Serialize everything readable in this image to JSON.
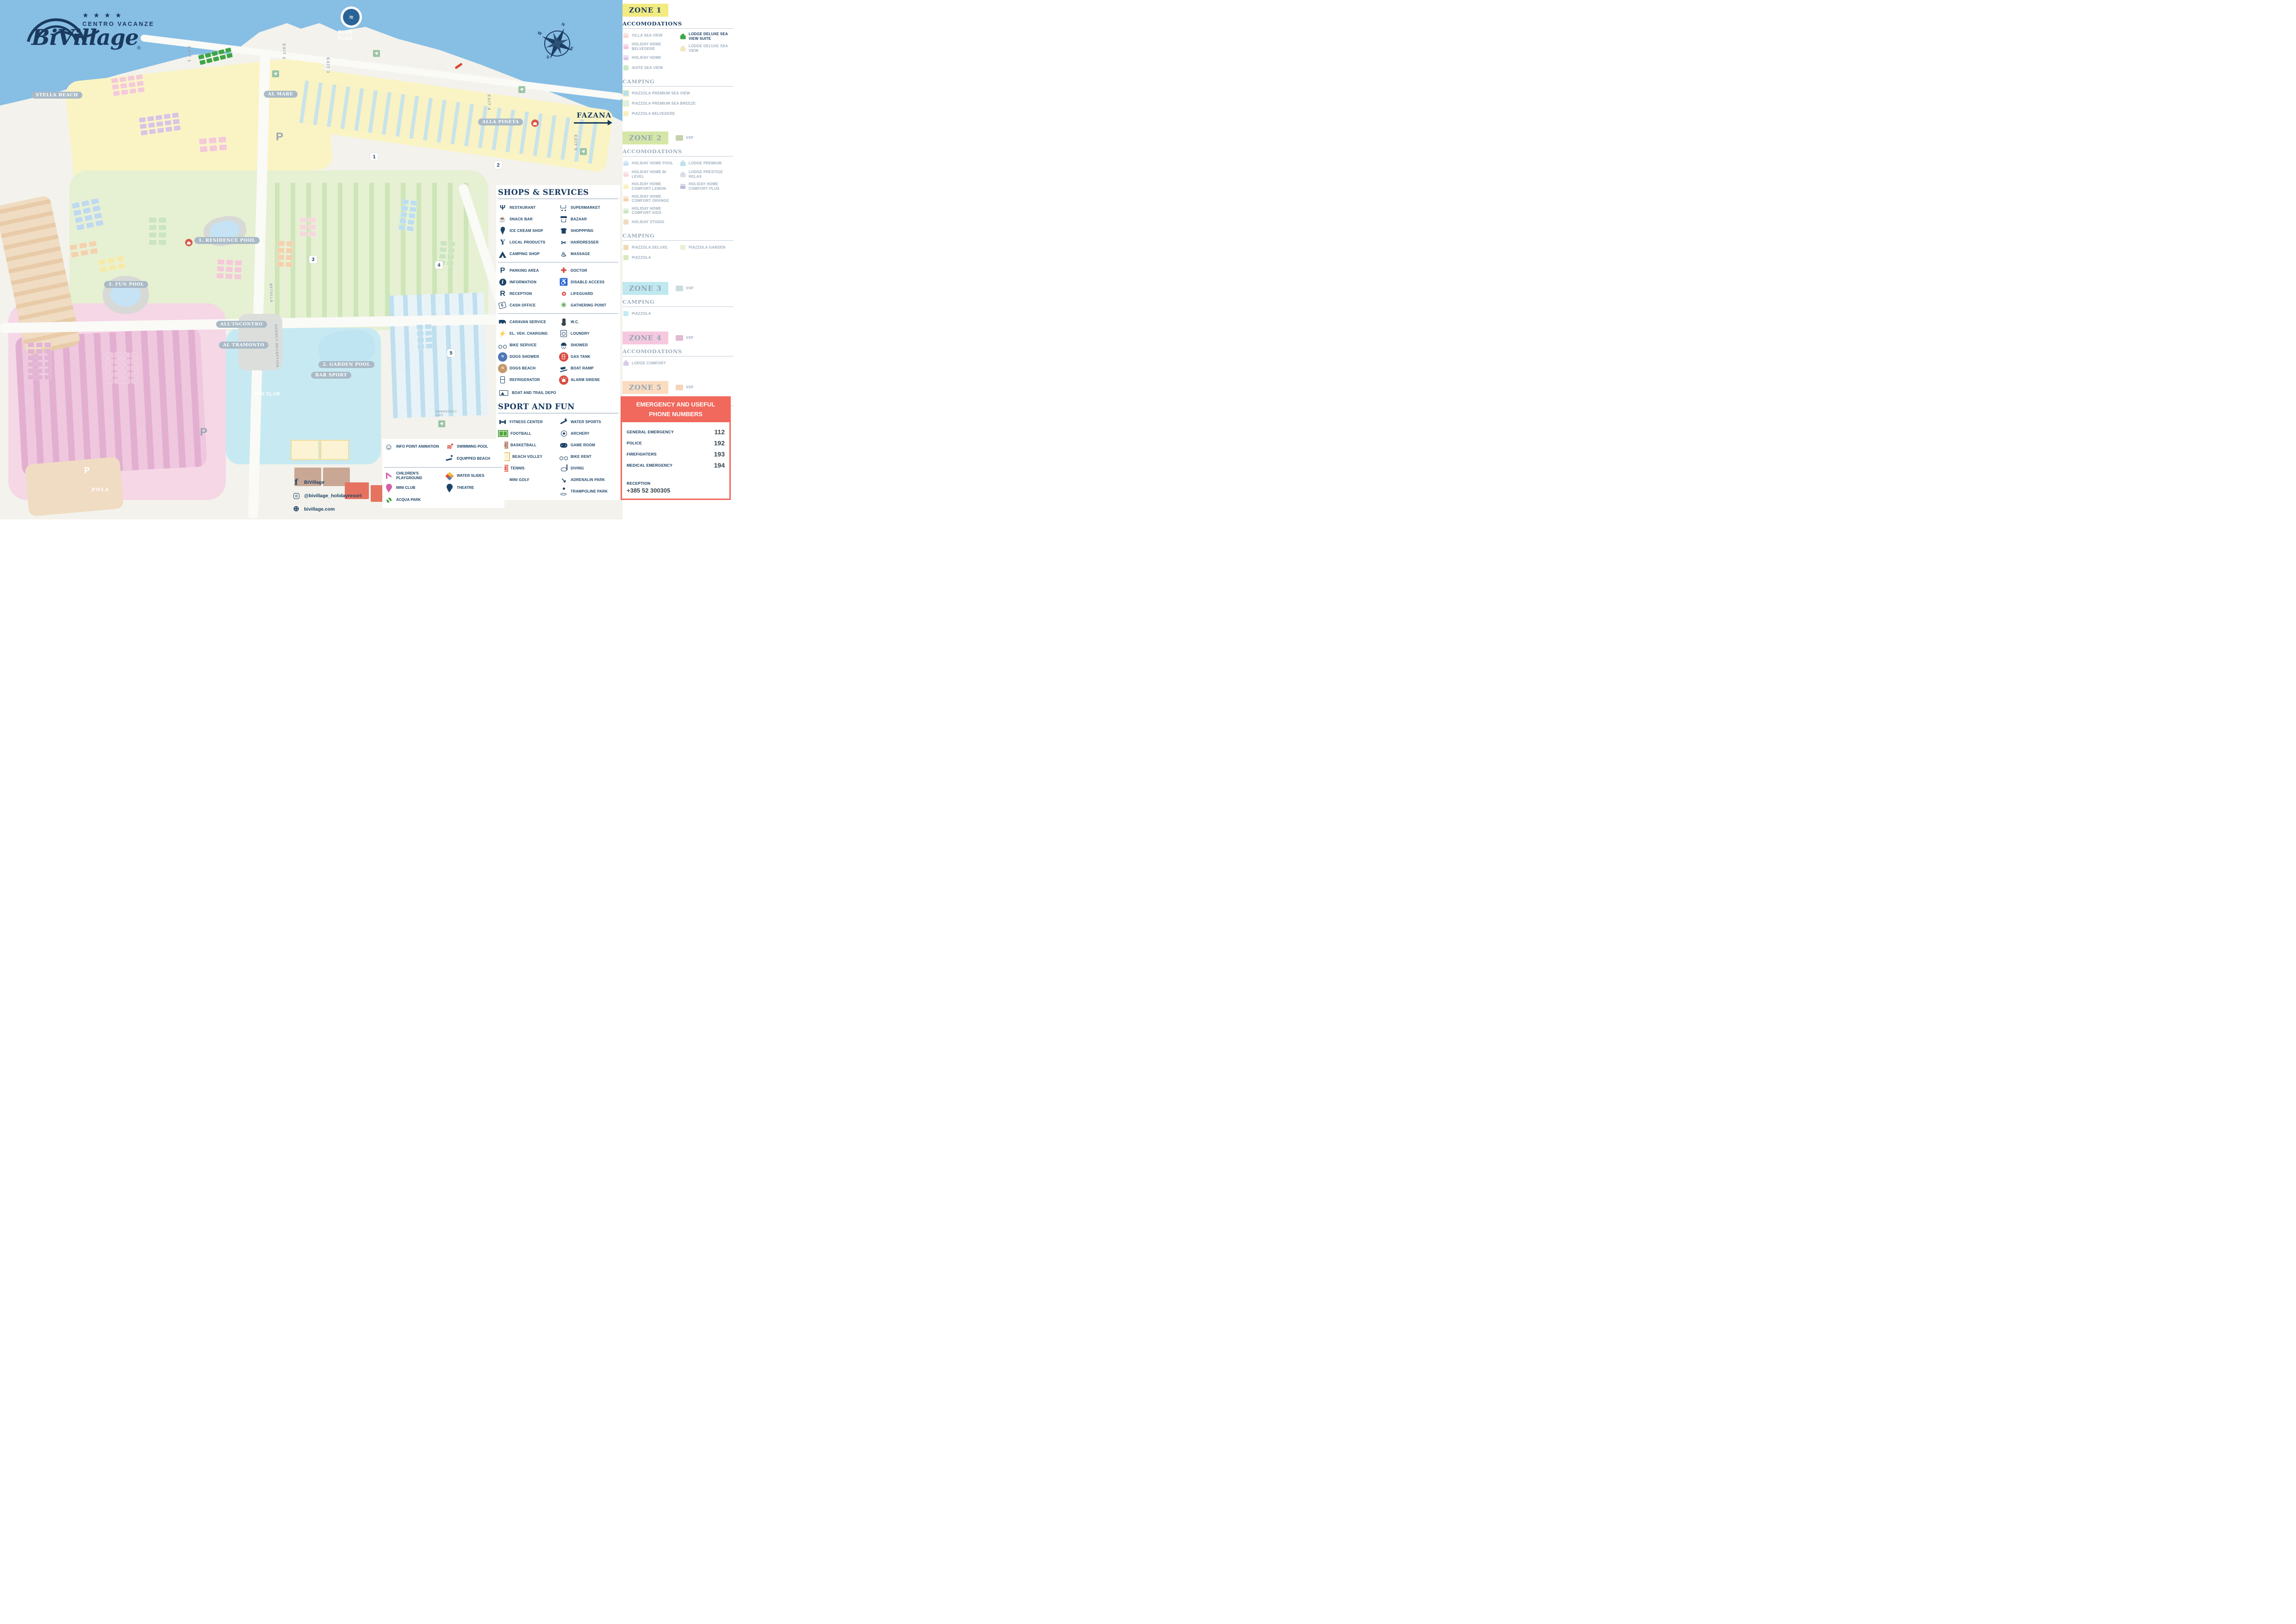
{
  "logo": {
    "stars": "★ ★ ★ ★",
    "line1": "CENTRO VACANZE",
    "name": "BiVillage",
    "reg": "®"
  },
  "vxp_label": "VXP",
  "map": {
    "sea_color": "#87BEE4",
    "labels": {
      "stella_beach": "STELLA BEACH",
      "al_mare": "AL MARE",
      "alla_pineta": "ALLA PINETA",
      "residence_pool": "1. RESIDENCE POOL",
      "fun_pool": "3. FUN POOL",
      "garden_pool": "2. GARDEN POOL",
      "bar_sport": "BAR SPORT",
      "all_incontro": "ALL'INCONTRO",
      "al_tramonto": "AL TRAMONTO",
      "mini_club": "MINI CLUB",
      "pola": "POLA",
      "fazana": "FAZANA",
      "blue_flag": "BLUE FLAG",
      "betulla": "BETULLA",
      "agency_reception": "AGENCY RECEPTION",
      "emergency_exit": "EMERGENCY EXIT"
    },
    "exits": [
      "EXIT 1",
      "EXIT 2",
      "EXIT 3",
      "EXIT 4",
      "EXIT 5"
    ],
    "zone_markers": [
      "1",
      "2",
      "3",
      "4",
      "5"
    ],
    "compass": [
      "N",
      "E",
      "S",
      "W"
    ],
    "parking_label": "P"
  },
  "zones": [
    {
      "title": "ZONE 1",
      "badge": "#F2EB82",
      "active": true,
      "sections": [
        {
          "header": "ACCOMODATIONS",
          "active": true,
          "cols": [
            [
              {
                "label": "VILLA SEA VIEW",
                "color": "#F7D9CB",
                "kind": "house"
              },
              {
                "label": "HOLIDAY HOME BELVEDERE",
                "color": "#F4C3DB",
                "kind": "house"
              },
              {
                "label": "HOLIDAY HOME",
                "color": "#DCC6E4",
                "kind": "house"
              },
              {
                "label": "SUITE SEA VIEW",
                "color": "#C9E9C4",
                "kind": "chip"
              }
            ],
            [
              {
                "label": "LODGE DELUXE SEA VIEW SUITE",
                "color": "#3FA544",
                "kind": "lodge",
                "active": true
              },
              {
                "label": "LODGE DELUXE SEA VIEW",
                "color": "#F4E3C2",
                "kind": "lodge"
              }
            ]
          ]
        },
        {
          "header": "CAMPING",
          "cols": [
            [
              {
                "label": "PIAZZOLA PREMIUM SEA VIEW",
                "color": "#BCDFF0",
                "pad": "#F7F1BF"
              },
              {
                "label": "PIAZZOLA PREMIUM SEA BREEZE",
                "color": "#DEEEE8",
                "pad": "#F7F1BF"
              },
              {
                "label": "PIAZZOLA BELVEDERE",
                "color": "#F7F1BF"
              }
            ]
          ]
        }
      ]
    },
    {
      "title": "ZONE 2",
      "badge": "#D5E6A6",
      "vxp": "#C7D1AF",
      "sections": [
        {
          "header": "ACCOMODATIONS",
          "cols": [
            [
              {
                "label": "HOLIDAY HOME POOL",
                "color": "#C6DFF2",
                "kind": "house"
              },
              {
                "label": "HOLIDAY HOME BI LEVEL",
                "color": "#F6D8DB",
                "kind": "house"
              },
              {
                "label": "HOLIDAY HOME COMFORT LEMON",
                "color": "#F6F0BC",
                "kind": "house"
              },
              {
                "label": "HOLIDAY HOME COMFORT ORANGE",
                "color": "#F3D2AF",
                "kind": "house"
              },
              {
                "label": "HOLIDAY HOME COMFORT KIDS",
                "color": "#CBE5BF",
                "kind": "house"
              },
              {
                "label": "HOLIDAY STUDIO",
                "color": "#EFDCC2",
                "kind": "chip"
              }
            ],
            [
              {
                "label": "LODGE PREMIUM",
                "color": "#BFE0EC",
                "kind": "lodge"
              },
              {
                "label": "LODGE PRESTIGE RELAX",
                "color": "#D8DDEB",
                "kind": "lodge"
              },
              {
                "label": "HOLIDAY HOME COMFORT PLUS",
                "color": "#B7B9D6",
                "kind": "house"
              }
            ]
          ]
        },
        {
          "header": "CAMPING",
          "cols": [
            [
              {
                "label": "PIAZZOLA DELUXE",
                "color": "#EFDBB2"
              },
              {
                "label": "PIAZZOLA",
                "color": "#D6E9BB"
              }
            ],
            [
              {
                "label": "PIAZZOLA GARDEN",
                "color": "#E9F1D4"
              }
            ]
          ]
        }
      ]
    },
    {
      "title": "ZONE 3",
      "badge": "#BFE8F0",
      "vxp": "#CBDCDF",
      "sections": [
        {
          "header": "CAMPING",
          "cols": [
            [
              {
                "label": "PIAZZOLA",
                "color": "#C6EBF3"
              }
            ]
          ]
        }
      ]
    },
    {
      "title": "ZONE 4",
      "badge": "#F6C8DF",
      "vxp": "#E1BAD2",
      "sections": [
        {
          "header": "ACCOMODATIONS",
          "cols": [
            [
              {
                "label": "LODGE COMFORT",
                "color": "#D9CBE7",
                "kind": "lodge"
              }
            ]
          ]
        }
      ]
    },
    {
      "title": "ZONE 5",
      "badge": "#FBDCC0",
      "vxp": "#F3D5B7",
      "sections": [
        {
          "header": "ACCOMODATIONS",
          "cols": [
            [
              {
                "label": "LODGE PRESTIGE LAGUNA",
                "color": "#C1CCB3",
                "kind": "lodge"
              }
            ]
          ]
        }
      ]
    }
  ],
  "services": {
    "title": "SHOPS & SERVICES",
    "groups": [
      {
        "left": [
          {
            "icon": "restaurant",
            "label": "RESTAURANT"
          },
          {
            "icon": "snack-bar",
            "label": "SNACK BAR"
          },
          {
            "icon": "ice-cream",
            "label": "ICE CREAM SHOP"
          },
          {
            "icon": "local-products",
            "label": "LOCAL PRODUCTS"
          },
          {
            "icon": "camping-shop",
            "label": "CAMPING SHOP"
          }
        ],
        "right": [
          {
            "icon": "supermarket",
            "label": "SUPERMARKET"
          },
          {
            "icon": "bazaar",
            "label": "BAZAAR"
          },
          {
            "icon": "shopping",
            "label": "SHOPPPING"
          },
          {
            "icon": "hairdresser",
            "label": "HAIRDRESSER"
          },
          {
            "icon": "massage",
            "label": "MASSAGE"
          }
        ]
      },
      {
        "left": [
          {
            "icon": "parking-area",
            "label": "PARKING AREA"
          },
          {
            "icon": "information",
            "label": "INFORMATION"
          },
          {
            "icon": "reception",
            "label": "RECEPTION"
          },
          {
            "icon": "cash-office",
            "label": "CASH OFFICE"
          }
        ],
        "right": [
          {
            "icon": "doctor",
            "label": "DOCTOR"
          },
          {
            "icon": "disable-access",
            "label": "DISABLE ACCESS"
          },
          {
            "icon": "lifeguard",
            "label": "LIFEGUARD"
          },
          {
            "icon": "gathering-point",
            "label": "GATHERING POINT"
          }
        ]
      },
      {
        "left": [
          {
            "icon": "caravan-service",
            "label": "CARAVAN SERVICE"
          },
          {
            "icon": "el-veh-charging",
            "label": "EL. VEH. CHARGING"
          },
          {
            "icon": "bike-service",
            "label": "BIKE SERVICE"
          },
          {
            "icon": "dogs-shower",
            "label": "DOGS SHOWER"
          },
          {
            "icon": "dogs-beach",
            "label": "DOGS BEACH"
          },
          {
            "icon": "refrigerator",
            "label": "REFRIGERATOR"
          }
        ],
        "right": [
          {
            "icon": "wc",
            "label": "W.C."
          },
          {
            "icon": "loundry",
            "label": "LOUNDRY"
          },
          {
            "icon": "shower",
            "label": "SHOWER"
          },
          {
            "icon": "gas-tank",
            "label": "GAS TANK"
          },
          {
            "icon": "boat-ramp",
            "label": "BOAT RAMP"
          },
          {
            "icon": "alarm-sirene",
            "label": "ALARM SIRENE"
          }
        ],
        "span": {
          "icon": "boat-depo",
          "label": "BOAT AND TRAIL DEPO"
        }
      }
    ]
  },
  "sport": {
    "title": "SPORT AND FUN",
    "left": [
      {
        "icon": "fitness-center",
        "label": "FITNESS CENTER"
      },
      {
        "icon": "football",
        "label": "FOOTBALL"
      },
      {
        "icon": "basketball",
        "label": "BASKETBALL"
      },
      {
        "icon": "beach-volley",
        "label": "BEACH VOLLEY"
      },
      {
        "icon": "tennis",
        "label": "TENNIS"
      },
      {
        "icon": "mini-golf",
        "label": "MINI GOLF"
      }
    ],
    "right": [
      {
        "icon": "water-sports",
        "label": "WATER SPORTS"
      },
      {
        "icon": "archery",
        "label": "ARCHERY"
      },
      {
        "icon": "game-room",
        "label": "GAME ROOM"
      },
      {
        "icon": "bike-rent",
        "label": "BIKE RENT"
      },
      {
        "icon": "diving",
        "label": "DIVING"
      },
      {
        "icon": "adrenalin-park",
        "label": "ADRENALIN PARK"
      },
      {
        "icon": "trampoline-park",
        "label": "TRAMPOLINE PARK"
      }
    ]
  },
  "activities": {
    "left": [
      {
        "icon": "info-point",
        "label": "INFO POINT ANIMATION"
      },
      {
        "icon": "childrens-playground",
        "label": "CHILDREN'S PLAYGROUND"
      },
      {
        "icon": "mini-club",
        "label": "MINI CLUB"
      },
      {
        "icon": "acqua-park",
        "label": "ACQUA PARK"
      }
    ],
    "right": [
      {
        "icon": "swimming-pool",
        "label": "SWIMMING POOL"
      },
      {
        "icon": "equipped-beach",
        "label": "EQUIPPED BEACH"
      },
      {
        "icon": "water-slides",
        "label": "WATER SLIDES"
      },
      {
        "icon": "theatre",
        "label": "THEATRE"
      }
    ]
  },
  "social": [
    {
      "icon": "facebook",
      "label": "BiVillage"
    },
    {
      "icon": "instagram",
      "label": "@bivillage_holidayresort"
    },
    {
      "icon": "web",
      "label": "bivillage.com"
    }
  ],
  "emergency": {
    "title_line1": "EMERGENCY AND USEFUL",
    "title_line2": "PHONE NUMBERS",
    "rows": [
      [
        "GENERAL EMERGENCY",
        "112"
      ],
      [
        "POLICE",
        "192"
      ],
      [
        "FIREFIGHTERS",
        "193"
      ],
      [
        "MEDICAL EMERGENCY",
        "194"
      ]
    ],
    "reception_label": "RECEPTION",
    "reception_number": "+385 52 300305"
  }
}
